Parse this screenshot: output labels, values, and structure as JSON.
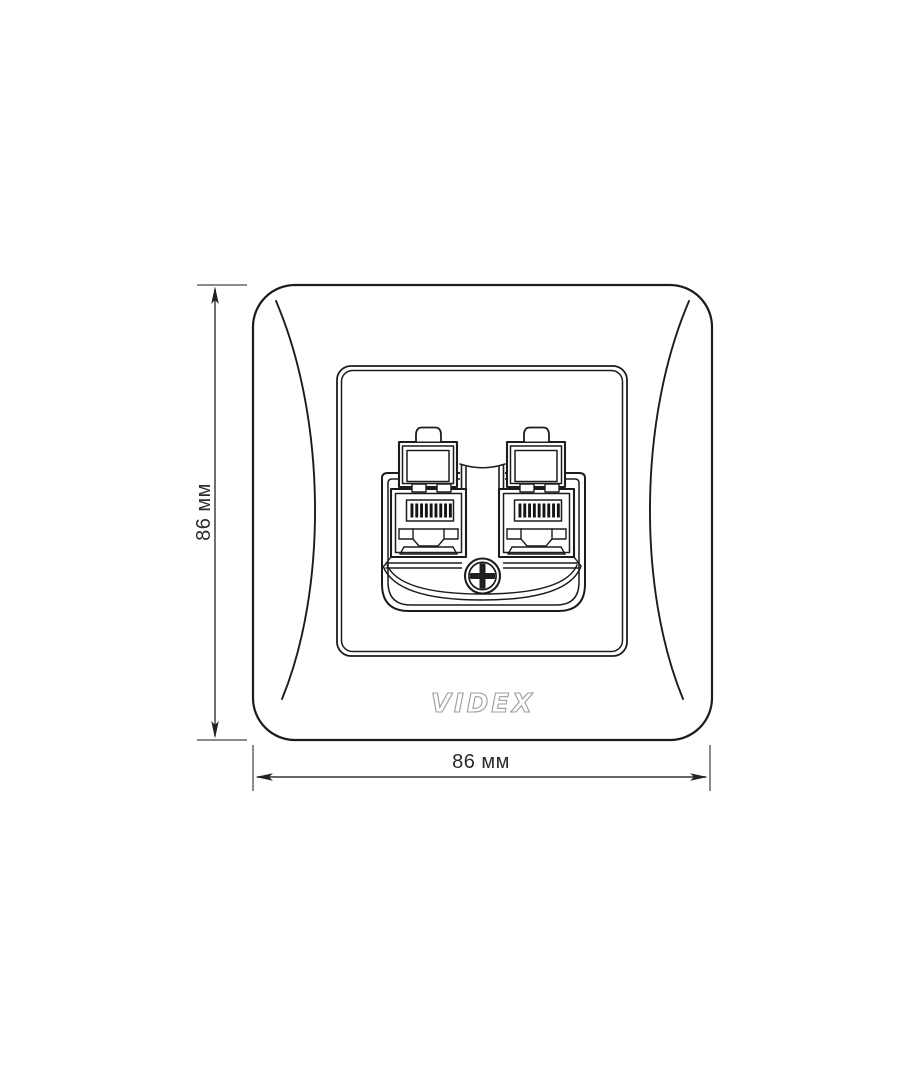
{
  "brand": {
    "logo_text": "VIDEX"
  },
  "dimensions": {
    "height_label": "86 мм",
    "width_label": "86 мм"
  },
  "drawing": {
    "subject": "double RJ45 socket faceplate front view",
    "jack_contact_bars_per_port": 9
  },
  "colors": {
    "background": "#ffffff",
    "outline": "#1c1c1c",
    "dimension_tick": "#8c8c8c",
    "dimension_arrow": "#333333",
    "logo_outline": "#9c9c9c",
    "contact_bars": "#141414"
  }
}
